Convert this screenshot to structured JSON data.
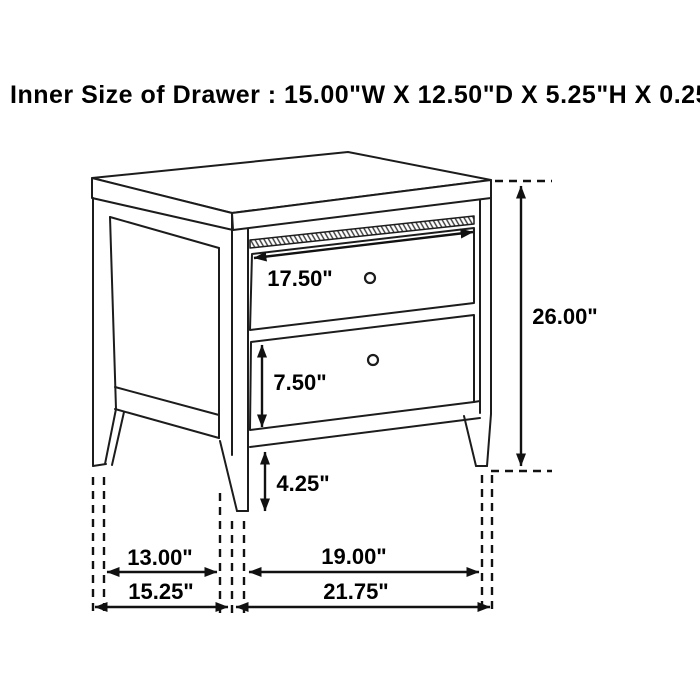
{
  "title": "Inner Size of Drawer : 15.00\"W X 12.50\"D X 5.25\"H X 0.25\"T",
  "diagram": {
    "subject": "two-drawer nightstand dimension line drawing",
    "annotations": {
      "top_drawer_width": "17.50\"",
      "bottom_drawer_height": "7.50\"",
      "base_clearance_height": "4.25\"",
      "overall_height": "26.00\"",
      "side_inner_width": "13.00\"",
      "front_inner_width": "19.00\"",
      "side_overall_width": "15.25\"",
      "front_overall_width": "21.75\""
    },
    "colors": {
      "line": "#1c1c1c",
      "dimension_line": "#111111",
      "background": "#ffffff"
    }
  }
}
